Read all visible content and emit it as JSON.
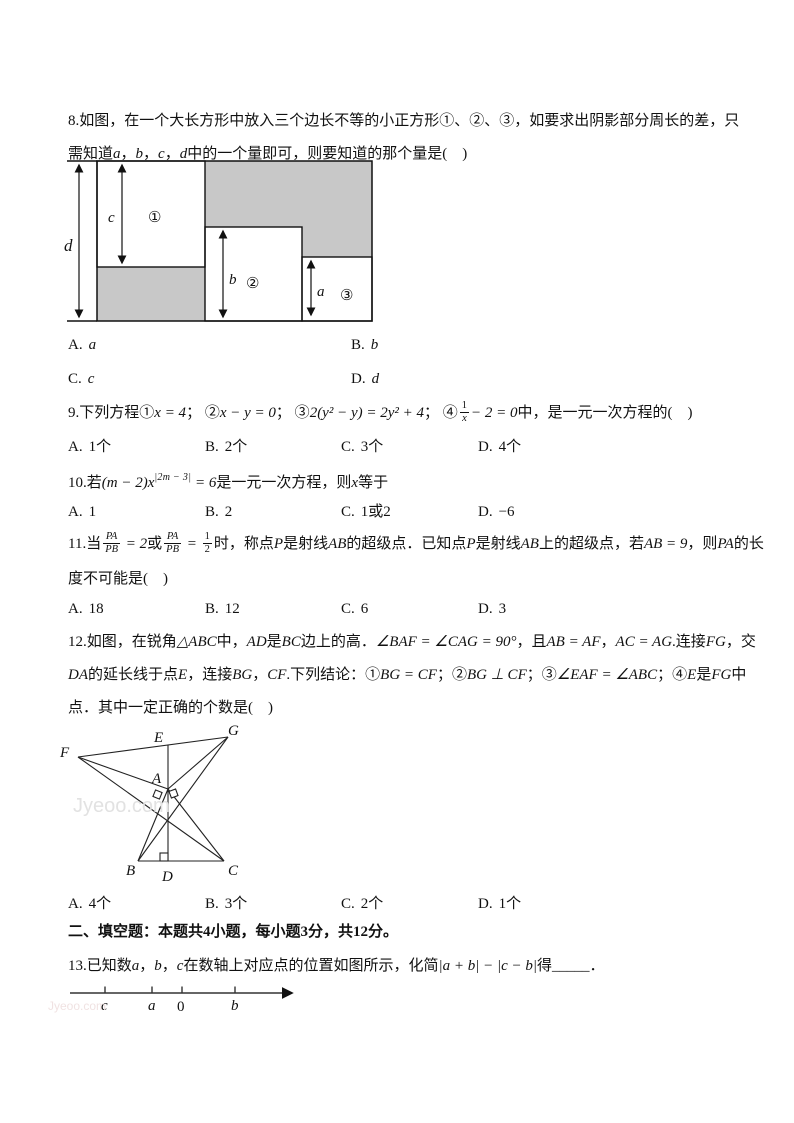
{
  "doc": {
    "watermark": "Jyeoo.com"
  },
  "q8": {
    "l1": "8.如图，在一个大长方形中放入三个边长不等的小正方形①、②、③，如要求出阴影部分周长的差，只",
    "l2": [
      "需知道",
      "a",
      "，",
      "b",
      "，",
      "c",
      "，",
      "d",
      "中的一个量即可，则要知道的那个量是(　)"
    ],
    "fig": {
      "d": "d",
      "c": "c",
      "s1": "①",
      "b": "b",
      "s2": "②",
      "a": "a",
      "s3": "③"
    },
    "options": [
      {
        "label": "A.",
        "text": "a"
      },
      {
        "label": "B.",
        "text": "b"
      },
      {
        "label": "C.",
        "text": "c"
      },
      {
        "label": "D.",
        "text": "d"
      }
    ]
  },
  "q9": {
    "p0": "9.下列方程",
    "c1": "①",
    "m1": "x = 4",
    "s1": "；  ",
    "c2": "②",
    "m2": "x − y = 0",
    "s2": "；  ",
    "c3": "③",
    "m3": "2(y² − y) = 2y² + 4",
    "s3": "；  ",
    "c4": "④",
    "frac": {
      "n": "1",
      "d": "x"
    },
    "m4": "− 2 = 0",
    "p1": "中，是一元一次方程的(　)",
    "options": [
      {
        "label": "A.",
        "text": "1个"
      },
      {
        "label": "B.",
        "text": "2个"
      },
      {
        "label": "C.",
        "text": "3个"
      },
      {
        "label": "D.",
        "text": "4个"
      }
    ]
  },
  "q10": {
    "p0": "10.若",
    "m0": "(m − 2)x",
    "sup": "|2m − 3|",
    "m1": " = 6",
    "p1": "是一元一次方程，则",
    "m2": "x",
    "p2": "等于",
    "options": [
      {
        "label": "A.",
        "text": "1"
      },
      {
        "label": "B.",
        "text": "2"
      },
      {
        "label": "C.",
        "text": "1或2"
      },
      {
        "label": "D.",
        "text": "−6"
      }
    ]
  },
  "q11": {
    "p0": "11.当",
    "f1": {
      "n": "PA",
      "d": "PB"
    },
    "m1": " = 2",
    "p1": "或",
    "f2": {
      "n": "PA",
      "d": "PB"
    },
    "m2": " = ",
    "f3": {
      "n": "1",
      "d": "2"
    },
    "p2": "时，称点",
    "m3": "P",
    "p3": "是射线",
    "m4": "AB",
    "p4": "的超级点．已知点",
    "m5": "P",
    "p5": "是射线",
    "m6": "AB",
    "p6": "上的超级点，若",
    "m7": "AB = 9",
    "p7": "，则",
    "m8": "PA",
    "p8": "的长",
    "l2": "度不可能是(　)",
    "options": [
      {
        "label": "A.",
        "text": "18"
      },
      {
        "label": "B.",
        "text": "12"
      },
      {
        "label": "C.",
        "text": "6"
      },
      {
        "label": "D.",
        "text": "3"
      }
    ]
  },
  "q12": {
    "l1": [
      "12.如图，在锐角",
      "△ABC",
      "中，",
      "AD",
      "是",
      "BC",
      "边上的高．",
      "∠BAF = ∠CAG = 90°",
      "，且",
      "AB = AF",
      "，",
      "AC = AG",
      ".连接",
      "FG",
      "，交"
    ],
    "l2": [
      "DA",
      "的延长线于点",
      "E",
      "，连接",
      "BG",
      "，",
      "CF",
      ".下列结论：",
      "①",
      "BG = CF",
      "；",
      "②",
      "BG ⊥ CF",
      "；",
      "③",
      "∠EAF = ∠ABC",
      "；",
      "④",
      "E",
      "是",
      "FG",
      "中"
    ],
    "l3": "点．其中一定正确的个数是(　)",
    "fig": {
      "F": "F",
      "G": "G",
      "E": "E",
      "A": "A",
      "B": "B",
      "D": "D",
      "C": "C"
    },
    "options": [
      {
        "label": "A.",
        "text": "4个"
      },
      {
        "label": "B.",
        "text": "3个"
      },
      {
        "label": "C.",
        "text": "2个"
      },
      {
        "label": "D.",
        "text": "1个"
      }
    ]
  },
  "section2": "二、填空题：本题共4小题，每小题3分，共12分。",
  "q13": {
    "parts": [
      "13.已知数",
      "a",
      "，",
      "b",
      "，",
      "c",
      "在数轴上对应点的位置如图所示，化简",
      "|a + b| − |c − b|",
      "得",
      "_____",
      "．"
    ],
    "axis": {
      "c": "c",
      "a": "a",
      "zero": "0",
      "b": "b"
    }
  }
}
